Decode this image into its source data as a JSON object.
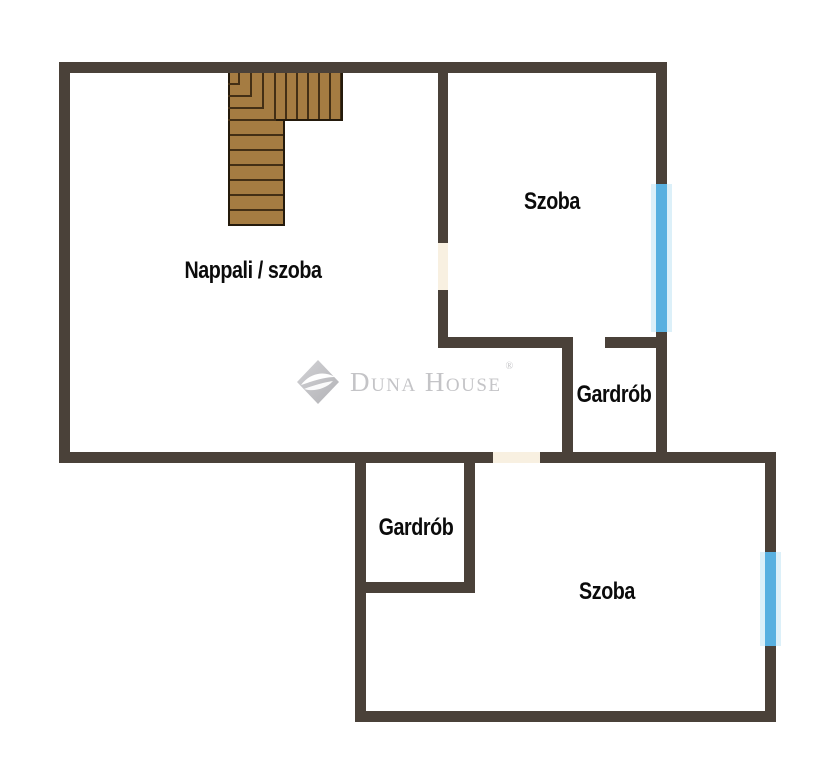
{
  "floorplan": {
    "rooms": [
      {
        "id": "nappali-szoba",
        "label": "Nappali / szoba"
      },
      {
        "id": "szoba-top",
        "label": "Szoba"
      },
      {
        "id": "gardrob-right",
        "label": "Gardrób"
      },
      {
        "id": "gardrob-bottom",
        "label": "Gardrób"
      },
      {
        "id": "szoba-bottom",
        "label": "Szoba"
      }
    ],
    "watermark": {
      "brand": "Duna House",
      "registered": "®"
    },
    "features": {
      "staircase": "L-shaped wooden staircase at top of living room",
      "windows": [
        "top-right exterior wall",
        "bottom-right exterior wall"
      ],
      "door_openings": [
        "between Nappali / szoba and top Szoba",
        "between Nappali / szoba and bottom Szoba",
        "into right Gardrób"
      ]
    },
    "colors": {
      "wall": "#4a4139",
      "window": "#58b0e0",
      "window_edge": "#dcf0f9",
      "door": "#f8f0e1",
      "wood": "#a57c42",
      "wood_line": "#432f15",
      "wood_edge": "#241a0c",
      "label": "#0b0b0b",
      "watermark": "#c4c4c7"
    }
  }
}
